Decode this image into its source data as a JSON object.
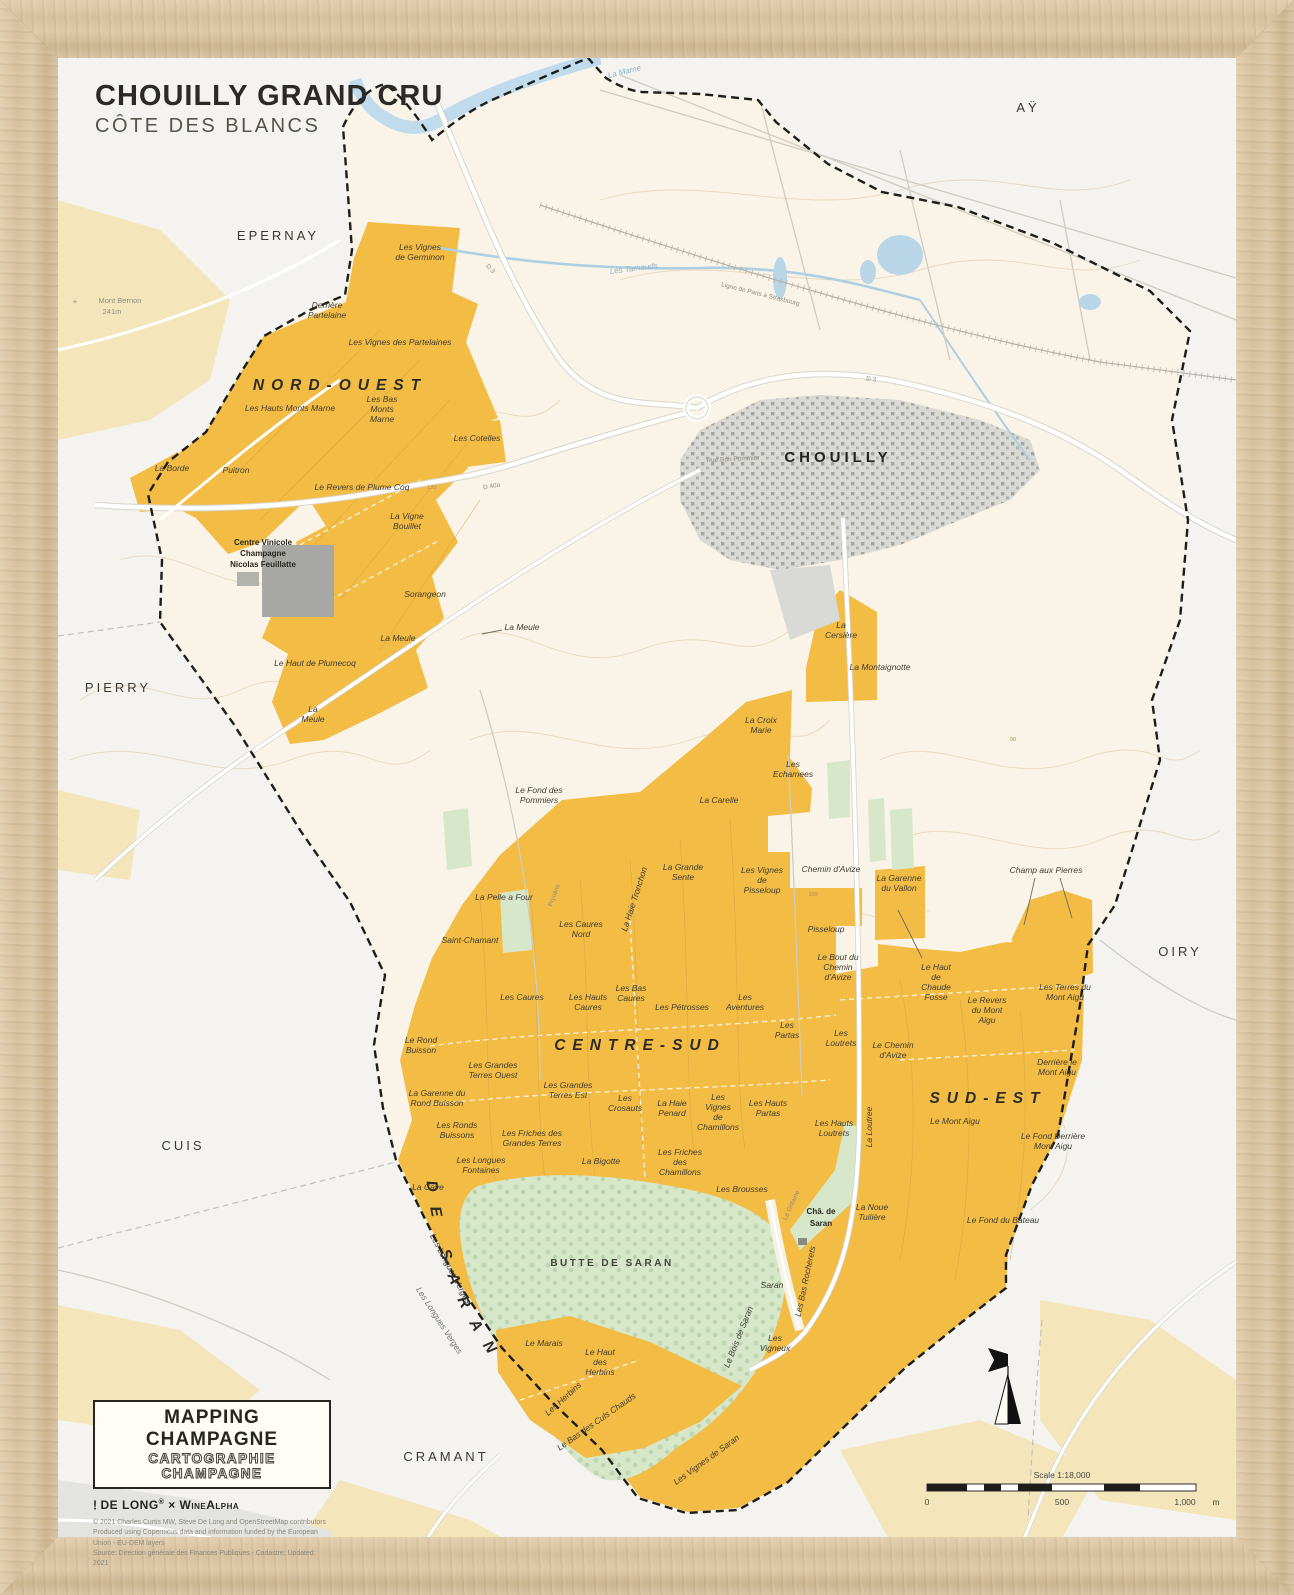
{
  "title": {
    "main": "CHOUILLY GRAND CRU",
    "sub": "CÔTE DES BLANCS"
  },
  "towns": [
    "EPERNAY",
    "AŸ",
    "CHOUILLY",
    "PIERRY",
    "OIRY",
    "CUIS",
    "CRAMANT"
  ],
  "regions": [
    "NORD-OUEST",
    "CENTRE-SUD",
    "SUD-EST",
    "AUTOUR DE SARAN"
  ],
  "forest_label": "BUTTE DE SARAN",
  "peak": {
    "name": "Mont Bernon",
    "elevation": "241m",
    "marker": "+"
  },
  "chateau": {
    "lines": [
      "Châ. de",
      "Saran"
    ]
  },
  "coop": {
    "lines": [
      "Centre Vinicole",
      "Champagne",
      "Nicolas Feuillatte"
    ]
  },
  "waters": [
    "La Marne",
    "Les Tarnauds"
  ],
  "roads": [
    "D 3",
    "D 40a",
    "Ligne de Paris à Strasbourg",
    "Rue Bon Pommier",
    "Pryolins",
    "La Haie Tronchon",
    "La Loutree",
    "La Grifaine"
  ],
  "contour_marks": [
    "120",
    "100",
    "90"
  ],
  "vineyards": [
    {
      "lines": [
        "Les Vignes",
        "de Germinon"
      ]
    },
    {
      "lines": [
        "Derrière",
        "Partelaine"
      ]
    },
    {
      "lines": [
        "Les Vignes des Partelaines"
      ]
    },
    {
      "lines": [
        "Les Hauts Monts Marne"
      ]
    },
    {
      "lines": [
        "Les Bas",
        "Monts",
        "Marne"
      ]
    },
    {
      "lines": [
        "Les Cotelles"
      ]
    },
    {
      "lines": [
        "La Borde"
      ]
    },
    {
      "lines": [
        "Puitron"
      ]
    },
    {
      "lines": [
        "Le Revers de Plume Coq"
      ]
    },
    {
      "lines": [
        "La Vigne",
        "Bouillet"
      ]
    },
    {
      "lines": [
        "Sorangeon"
      ]
    },
    {
      "lines": [
        "La Meule"
      ]
    },
    {
      "lines": [
        "La Meule"
      ]
    },
    {
      "lines": [
        "Le Haut de Plumecoq"
      ]
    },
    {
      "lines": [
        "La",
        "Meule"
      ]
    },
    {
      "lines": [
        "La",
        "Cersière"
      ]
    },
    {
      "lines": [
        "La Montaignotte"
      ]
    },
    {
      "lines": [
        "La Croix",
        "Marie"
      ]
    },
    {
      "lines": [
        "Les",
        "Echamees"
      ]
    },
    {
      "lines": [
        "La Carelle"
      ]
    },
    {
      "lines": [
        "Le Fond des",
        "Pommiers"
      ]
    },
    {
      "lines": [
        "La Grande",
        "Sente"
      ]
    },
    {
      "lines": [
        "Les Vignes",
        "de",
        "Pisseloup"
      ]
    },
    {
      "lines": [
        "La Pelle a Four"
      ]
    },
    {
      "lines": [
        "Saint-Chamant"
      ]
    },
    {
      "lines": [
        "Les Caures",
        "Nord"
      ]
    },
    {
      "lines": [
        "Chemin d'Avize"
      ]
    },
    {
      "lines": [
        "La Garenne",
        "du Vallon"
      ]
    },
    {
      "lines": [
        "Champ aux Pierres"
      ]
    },
    {
      "lines": [
        "Pisseloup"
      ]
    },
    {
      "lines": [
        "Le Bout du",
        "Chemin",
        "d'Avize"
      ]
    },
    {
      "lines": [
        "Le Haut",
        "de",
        "Chaude",
        "Fosse"
      ]
    },
    {
      "lines": [
        "Le Revers",
        "du Mont",
        "Aigu"
      ]
    },
    {
      "lines": [
        "Les Terres du",
        "Mont Aigu"
      ]
    },
    {
      "lines": [
        "Les Caures"
      ]
    },
    {
      "lines": [
        "Les Hauts",
        "Caures"
      ]
    },
    {
      "lines": [
        "Les Bas",
        "Caures"
      ]
    },
    {
      "lines": [
        "Les Pétrosses"
      ]
    },
    {
      "lines": [
        "Les",
        "Aventures"
      ]
    },
    {
      "lines": [
        "Les",
        "Partas"
      ]
    },
    {
      "lines": [
        "Les",
        "Loutrets"
      ]
    },
    {
      "lines": [
        "Le Chemin",
        "d'Avize"
      ]
    },
    {
      "lines": [
        "Les",
        "Vignes",
        "de",
        "Chamillons"
      ]
    },
    {
      "lines": [
        "Les Hauts",
        "Partas"
      ]
    },
    {
      "lines": [
        "Le Rond",
        "Buisson"
      ]
    },
    {
      "lines": [
        "Les Grandes",
        "Terres Ouest"
      ]
    },
    {
      "lines": [
        "La Garenne du",
        "Rond Buisson"
      ]
    },
    {
      "lines": [
        "Les Grandes",
        "Terres Est"
      ]
    },
    {
      "lines": [
        "Les",
        "Crosauts"
      ]
    },
    {
      "lines": [
        "La Haie",
        "Penard"
      ]
    },
    {
      "lines": [
        "Les Ronds",
        "Buissons"
      ]
    },
    {
      "lines": [
        "Les Friches des",
        "Grandes Terres"
      ]
    },
    {
      "lines": [
        "Les Longues",
        "Fontaines"
      ]
    },
    {
      "lines": [
        "La Cave"
      ]
    },
    {
      "lines": [
        "La Bigotte"
      ]
    },
    {
      "lines": [
        "Les Friches",
        "des",
        "Chamillons"
      ]
    },
    {
      "lines": [
        "Les Brousses"
      ]
    },
    {
      "lines": [
        "Les Hauts",
        "Loutrets"
      ]
    },
    {
      "lines": [
        "Le Mont Aigu"
      ]
    },
    {
      "lines": [
        "Derrière le",
        "Mont Aigu"
      ]
    },
    {
      "lines": [
        "Le Fond Derrière",
        "Mont Aigu"
      ]
    },
    {
      "lines": [
        "La Noue",
        "Tuilière"
      ]
    },
    {
      "lines": [
        "Le Fond du Bateau"
      ]
    },
    {
      "lines": [
        "Saran"
      ]
    },
    {
      "lines": [
        "Les",
        "Vigneux"
      ]
    },
    {
      "lines": [
        "Le Marais"
      ]
    },
    {
      "lines": [
        "Le Haut",
        "des",
        "Herbins"
      ]
    },
    {
      "lines": [
        "Les Herbins"
      ]
    },
    {
      "lines": [
        "Le Bas des Culs Chauds"
      ]
    },
    {
      "lines": [
        "Les Longues Verges"
      ]
    },
    {
      "lines": [
        "Les Longues Verges"
      ]
    },
    {
      "lines": [
        "Le Bois de Saran"
      ]
    },
    {
      "lines": [
        "Les Bas Rocherets"
      ]
    },
    {
      "lines": [
        "Les Vignes de Saran"
      ]
    }
  ],
  "legend": {
    "title": "MAPPING CHAMPAGNE",
    "subtitle": "CARTOGRAPHIE CHAMPAGNE",
    "brand_mark": "!",
    "brand": "DE LONG",
    "brand_reg": "®",
    "separator": "×",
    "brand2": "WineAlpha",
    "credits": [
      "© 2021 Charles Curtis MW, Steve De Long and OpenStreetMap contributors",
      "Produced using Copernicus data and information funded by the European Union - EU-DEM layers",
      "Source: Direction générale des Finances Publiques - Cadastre; Updated: 2021"
    ]
  },
  "scalebar": {
    "label": "Scale 1:18,000",
    "tick0": "0",
    "tick500": "500",
    "tick1000": "1,000",
    "unit": "m"
  },
  "compass": {
    "icon": "north-arrow"
  },
  "colors": {
    "cru_orange": "#f2bc45",
    "other_vineyard": "#f4e5ba",
    "forest_green": "#d7e7ca",
    "water_blue": "#bcd9ec",
    "town_gray": "#d9d9d6",
    "inside_cream": "#f9f4e7",
    "outside_white": "#f4f3f0",
    "boundary_black": "#1d1d1a",
    "frame_wood": "#d9c3a3"
  }
}
